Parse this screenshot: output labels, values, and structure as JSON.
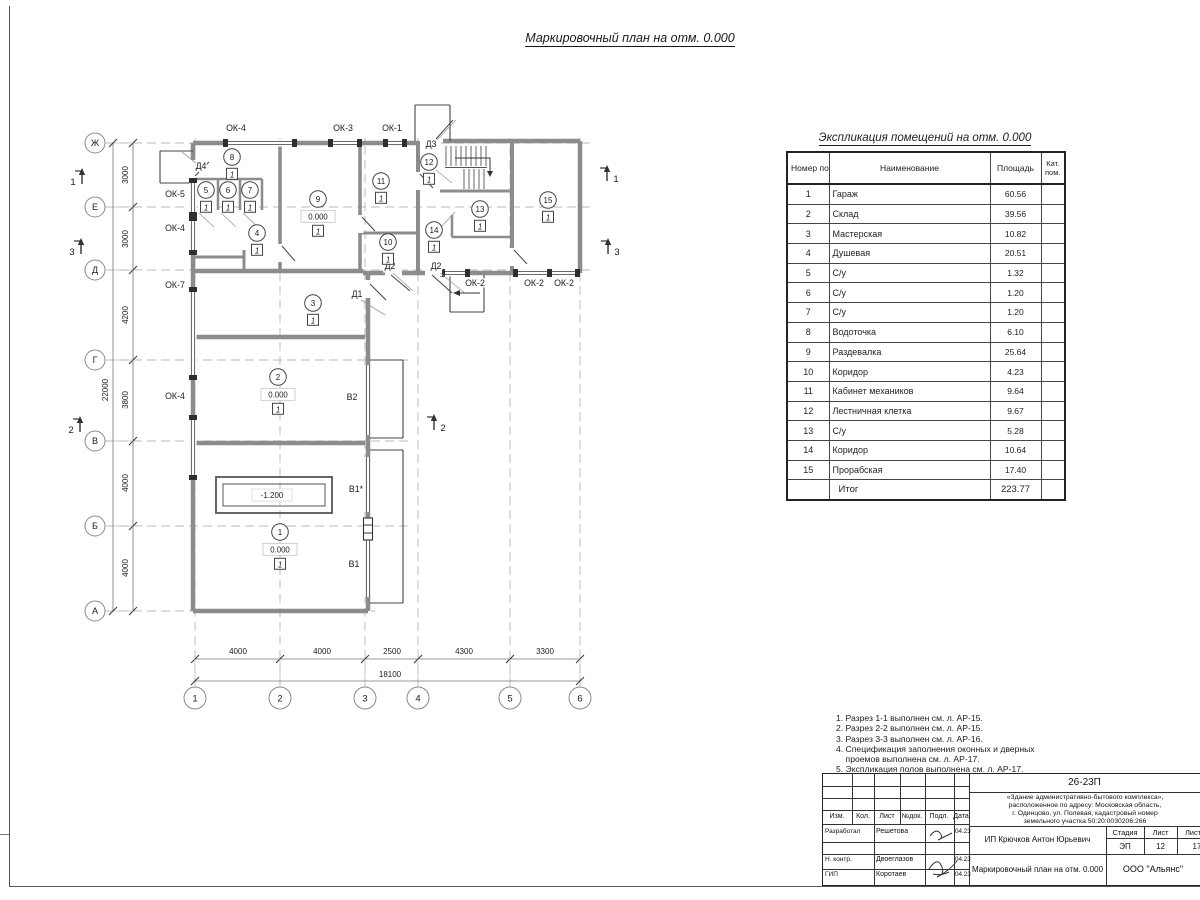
{
  "sheet": {
    "title": "Маркировочный план на отм. 0.000"
  },
  "schedule": {
    "title": "Экспликация помещений на отм. 0.000",
    "headers": {
      "num": "Номер помещ.",
      "name": "Наименование",
      "area": "Площадь",
      "cat": "Кат. пом."
    },
    "rows": [
      [
        "1",
        "Гараж",
        "60.56"
      ],
      [
        "2",
        "Склад",
        "39.56"
      ],
      [
        "3",
        "Мастерская",
        "10.82"
      ],
      [
        "4",
        "Душевая",
        "20.51"
      ],
      [
        "5",
        "С/у",
        "1.32"
      ],
      [
        "6",
        "С/у",
        "1.20"
      ],
      [
        "7",
        "С/у",
        "1.20"
      ],
      [
        "8",
        "Водоточка",
        "6.10"
      ],
      [
        "9",
        "Раздевалка",
        "25.64"
      ],
      [
        "10",
        "Коридор",
        "4.23"
      ],
      [
        "11",
        "Кабинет механиков",
        "9.64"
      ],
      [
        "12",
        "Лестничная клетка",
        "9.67"
      ],
      [
        "13",
        "С/у",
        "5.28"
      ],
      [
        "14",
        "Коридор",
        "10.64"
      ],
      [
        "15",
        "Прорабская",
        "17.40"
      ]
    ],
    "total_label": "Итог",
    "total_area": "223.77"
  },
  "notes": [
    "1. Разрез 1-1 выполнен см. л. АР-15.",
    "2. Разрез 2-2 выполнен см. л. АР-15.",
    "3. Разрез 3-3 выполнен см. л. АР-16.",
    "4. Спецификация заполнения оконных и дверных",
    "    проемов выполнена см. л. АР-17.",
    "5. Экспликация полов выполнена см. л. АР-17."
  ],
  "titleblock": {
    "code": "26-23П",
    "project": [
      "«Здание административно-бытового комплекса»,",
      "расположенное по адресу: Московская область,",
      "г. Одинцово, ул. Полевая, кадастровый номер",
      "земельного участка 50:20:0030206:266"
    ],
    "columns": [
      "Изм.",
      "Кол.",
      "Лист",
      "№док.",
      "Подл.",
      "Дата"
    ],
    "people": [
      {
        "role": "Разработал",
        "name": "Решетова",
        "date": "04.23"
      },
      {
        "role": "Н. контр.",
        "name": "Двоеглазов",
        "date": "04.23"
      },
      {
        "role": "ГИП",
        "name": "Коротаев",
        "date": "04.23"
      }
    ],
    "client": "ИП Крючков Антон Юрьевич",
    "doc_title": "Маркировочный план на отм. 0.000",
    "org": "ООО \"Альянс\"",
    "stage_label": "Стадия",
    "sheet_label": "Лист",
    "sheets_label": "Листов",
    "stage": "ЭП",
    "sheet_num": "12",
    "sheets_total": "17"
  },
  "plan": {
    "axes_h": [
      {
        "label": "Ж",
        "y": 143,
        "xend": 592
      },
      {
        "label": "Е",
        "y": 207,
        "xend": 592
      },
      {
        "label": "Д",
        "y": 270,
        "xend": 592
      },
      {
        "label": "Г",
        "y": 360,
        "xend": 408
      },
      {
        "label": "В",
        "y": 441,
        "xend": 408
      },
      {
        "label": "Б",
        "y": 526,
        "xend": 408
      },
      {
        "label": "А",
        "y": 611,
        "xend": 375
      }
    ],
    "axes_v": [
      {
        "label": "1",
        "x": 195
      },
      {
        "label": "2",
        "x": 280
      },
      {
        "label": "3",
        "x": 365
      },
      {
        "label": "4",
        "x": 418
      },
      {
        "label": "5",
        "x": 510
      },
      {
        "label": "6",
        "x": 580
      }
    ],
    "dims_v": [
      {
        "text": "3000",
        "y": 175
      },
      {
        "text": "3000",
        "y": 239
      },
      {
        "text": "4200",
        "y": 315
      },
      {
        "text": "3800",
        "y": 400
      },
      {
        "text": "4000",
        "y": 483
      },
      {
        "text": "4000",
        "y": 568
      }
    ],
    "dim_v_total": "22000",
    "dims_h": [
      {
        "text": "4000",
        "x": 238
      },
      {
        "text": "4000",
        "x": 322
      },
      {
        "text": "2500",
        "x": 392
      },
      {
        "text": "4300",
        "x": 464
      },
      {
        "text": "3300",
        "x": 545
      }
    ],
    "dim_h_total": "18100",
    "opening_labels": [
      {
        "text": "ОК-4",
        "x": 236,
        "y": 131
      },
      {
        "text": "ОК-3",
        "x": 343,
        "y": 131
      },
      {
        "text": "ОК-1",
        "x": 392,
        "y": 131
      },
      {
        "text": "Д3",
        "x": 431,
        "y": 147
      },
      {
        "text": "Д4",
        "x": 201,
        "y": 169
      },
      {
        "text": "ОК-5",
        "x": 175,
        "y": 197
      },
      {
        "text": "ОК-4",
        "x": 175,
        "y": 231
      },
      {
        "text": "ОК-7",
        "x": 175,
        "y": 288
      },
      {
        "text": "ОК-4",
        "x": 175,
        "y": 399
      },
      {
        "text": "Д2",
        "x": 390,
        "y": 269
      },
      {
        "text": "Д2",
        "x": 436,
        "y": 269
      },
      {
        "text": "Д1",
        "x": 357,
        "y": 297
      },
      {
        "text": "ОК-2",
        "x": 475,
        "y": 286
      },
      {
        "text": "ОК-2",
        "x": 534,
        "y": 286
      },
      {
        "text": "ОК-2",
        "x": 564,
        "y": 286
      },
      {
        "text": "В2",
        "x": 352,
        "y": 400
      },
      {
        "text": "В1*",
        "x": 356,
        "y": 492
      },
      {
        "text": "В1",
        "x": 354,
        "y": 567
      }
    ],
    "rooms": [
      {
        "num": "1",
        "x": 280,
        "y": 532,
        "elev": "0.000",
        "floor": "1"
      },
      {
        "num": "2",
        "x": 278,
        "y": 377,
        "elev": "0.000",
        "floor": "1"
      },
      {
        "num": "3",
        "x": 313,
        "y": 303,
        "floor": "1"
      },
      {
        "num": "4",
        "x": 257,
        "y": 233,
        "floor": "1"
      },
      {
        "num": "5",
        "x": 206,
        "y": 190,
        "floor": "1"
      },
      {
        "num": "6",
        "x": 228,
        "y": 190,
        "floor": "1"
      },
      {
        "num": "7",
        "x": 250,
        "y": 190,
        "floor": "1"
      },
      {
        "num": "8",
        "x": 232,
        "y": 157,
        "floor": "1"
      },
      {
        "num": "9",
        "x": 318,
        "y": 199,
        "elev": "0.000",
        "floor": "1"
      },
      {
        "num": "10",
        "x": 388,
        "y": 242,
        "floor": "1"
      },
      {
        "num": "11",
        "x": 381,
        "y": 181,
        "floor": "1"
      },
      {
        "num": "12",
        "x": 429,
        "y": 162,
        "floor": "1"
      },
      {
        "num": "13",
        "x": 480,
        "y": 209,
        "floor": "1"
      },
      {
        "num": "14",
        "x": 434,
        "y": 230,
        "floor": "1"
      },
      {
        "num": "15",
        "x": 548,
        "y": 200,
        "floor": "1"
      }
    ],
    "pit_label": "-1.200",
    "sections": [
      {
        "label": "1",
        "x": 82,
        "y": 168,
        "numside": -1
      },
      {
        "label": "3",
        "x": 81,
        "y": 238,
        "numside": -1
      },
      {
        "label": "2",
        "x": 80,
        "y": 416,
        "numside": -1
      },
      {
        "label": "1",
        "x": 607,
        "y": 165,
        "numside": 1
      },
      {
        "label": "3",
        "x": 608,
        "y": 238,
        "numside": 1
      },
      {
        "label": "2",
        "x": 434,
        "y": 414,
        "numside": 1
      }
    ]
  }
}
